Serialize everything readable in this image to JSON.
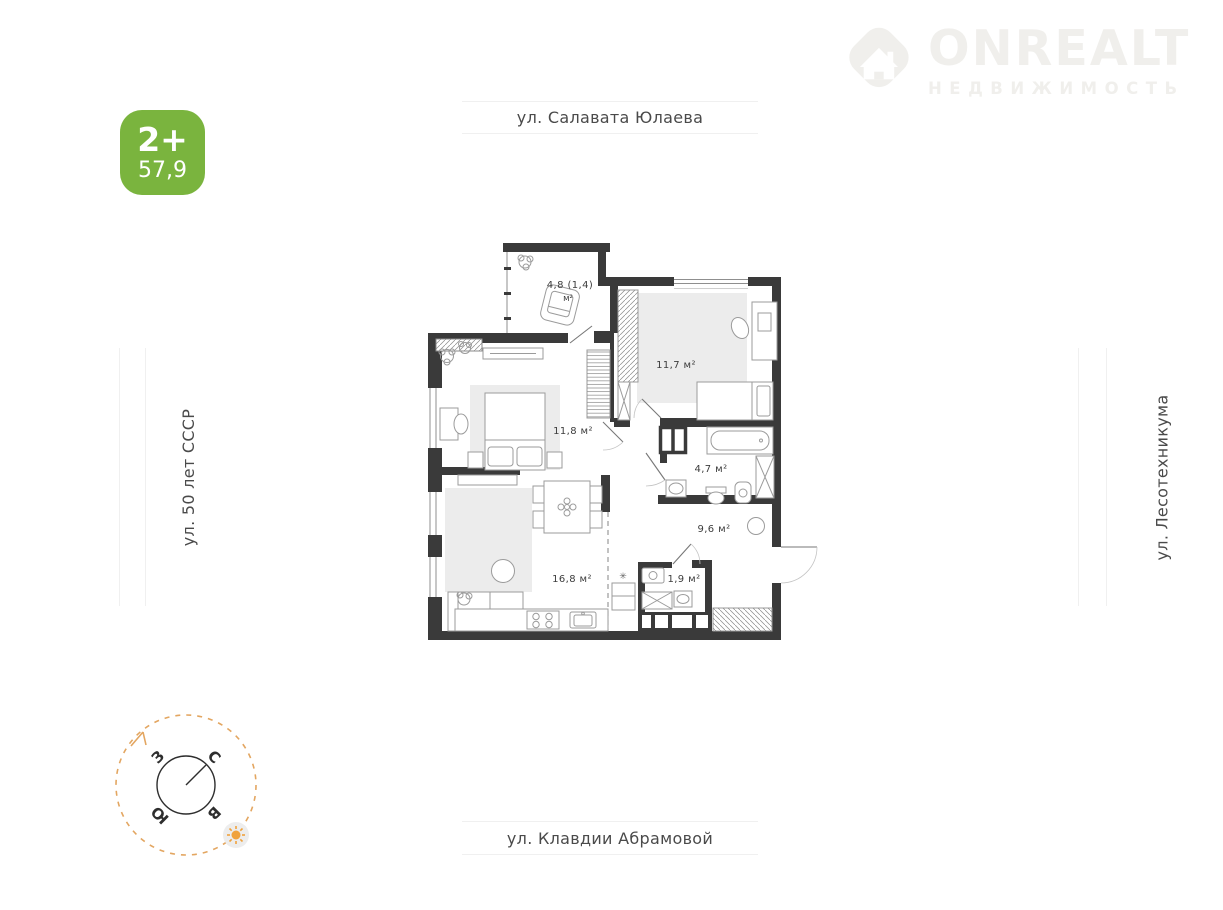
{
  "logo": {
    "title": "ONREALT",
    "subtitle": "НЕДВИЖИМОСТЬ"
  },
  "badge": {
    "rooms": "2+",
    "area": "57,9"
  },
  "streets": {
    "top": "ул. Салавата Юлаева",
    "left": "ул. 50 лет СССР",
    "right": "ул. Лесотехникума",
    "bottom": "ул. Клавдии Абрамовой"
  },
  "plan": {
    "rooms": [
      {
        "label": "4,8 (1,4)",
        "label2": "м²"
      },
      {
        "label": "11,7 м²"
      },
      {
        "label": "11,8 м²"
      },
      {
        "label": "4,7 м²"
      },
      {
        "label": "9,6 м²"
      },
      {
        "label": "16,8 м²"
      },
      {
        "label": "1,9 м²"
      }
    ],
    "utility_symbol": "✳"
  },
  "compass": {
    "n": "С",
    "w": "З",
    "s": "Ю",
    "e": "В"
  },
  "colors": {
    "accent-green": "#7ab43e",
    "wall": "#3a3a3a",
    "logo-gray": "#f0efec",
    "street-line": "#f0f0f0",
    "street-text": "#4a4a4a",
    "compass-accent": "#e3a661",
    "sun-orange": "#f0a23c",
    "rug": "#ececec",
    "furniture-line": "#9b9b9b",
    "label-text": "#3d3d3d"
  }
}
